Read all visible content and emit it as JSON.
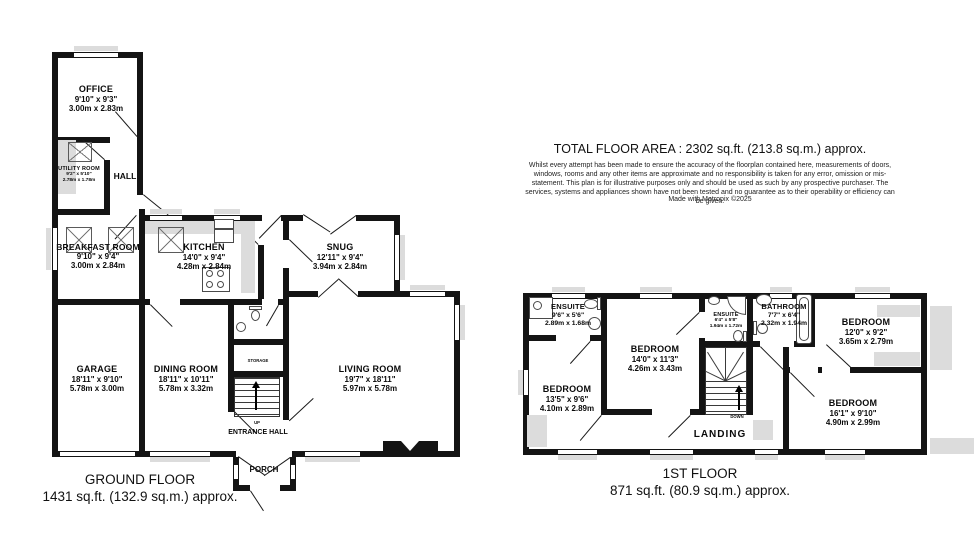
{
  "page": {
    "total_area": "TOTAL FLOOR AREA : 2302 sq.ft. (213.8 sq.m.) approx.",
    "disclaimer": "Whilst every attempt has been made to ensure the accuracy of the floorplan contained here, measurements of doors, windows, rooms and any other items are approximate and no responsibility is taken for any error, omission or mis-statement. This plan is for illustrative purposes only and should be used as such by any prospective purchaser. The services, systems and appliances shown have not been tested and no guarantee as to their operability or efficiency can be given.",
    "credit": "Made with Metropix ©2025"
  },
  "ground_floor": {
    "title": "GROUND FLOOR",
    "area": "1431 sq.ft. (132.9 sq.m.) approx.",
    "stairs_label": "UP",
    "rooms": {
      "office": {
        "name": "OFFICE",
        "imperial": "9'10\" x 9'3\"",
        "metric": "3.00m x 2.83m"
      },
      "utility": {
        "name": "UTILITY ROOM",
        "imperial": "9'2\" x 5'10\"",
        "metric": "2.78m x 1.78m"
      },
      "hall": {
        "name": "HALL"
      },
      "breakfast": {
        "name": "BREAKFAST ROOM",
        "imperial": "9'10\" x 9'4\"",
        "metric": "3.00m x 2.84m"
      },
      "kitchen": {
        "name": "KITCHEN",
        "imperial": "14'0\" x 9'4\"",
        "metric": "4.28m x 2.84m"
      },
      "snug": {
        "name": "SNUG",
        "imperial": "12'11\" x 9'4\"",
        "metric": "3.94m x 2.84m"
      },
      "garage": {
        "name": "GARAGE",
        "imperial": "18'11\" x 9'10\"",
        "metric": "5.78m x 3.00m"
      },
      "dining": {
        "name": "DINING ROOM",
        "imperial": "18'11\" x 10'11\"",
        "metric": "5.78m x 3.32m"
      },
      "living": {
        "name": "LIVING ROOM",
        "imperial": "19'7\" x 18'11\"",
        "metric": "5.97m x 5.78m"
      },
      "storage": {
        "name": "STORAGE"
      },
      "entrance": {
        "name": "ENTRANCE HALL"
      },
      "porch": {
        "name": "PORCH"
      }
    }
  },
  "first_floor": {
    "title": "1ST FLOOR",
    "area": "871 sq.ft. (80.9 sq.m.) approx.",
    "stairs_label": "DOWN",
    "rooms": {
      "ensuite1": {
        "name": "ENSUITE",
        "imperial": "9'6\" x 5'6\"",
        "metric": "2.89m x 1.68m"
      },
      "bedroom1": {
        "name": "BEDROOM",
        "imperial": "14'0\" x 11'3\"",
        "metric": "4.26m x 3.43m"
      },
      "bedroom2": {
        "name": "BEDROOM",
        "imperial": "13'5\" x 9'6\"",
        "metric": "4.10m x 2.89m"
      },
      "ensuite2": {
        "name": "ENSUITE",
        "imperial": "6'4\" x 5'8\"",
        "metric": "1.94m x 1.72m"
      },
      "bathroom": {
        "name": "BATHROOM",
        "imperial": "7'7\" x 6'4\"",
        "metric": "2.32m x 1.94m"
      },
      "bedroom3": {
        "name": "BEDROOM",
        "imperial": "12'0\" x 9'2\"",
        "metric": "3.65m x 2.79m"
      },
      "bedroom4": {
        "name": "BEDROOM",
        "imperial": "16'1\" x 9'10\"",
        "metric": "4.90m x 2.99m"
      },
      "landing": {
        "name": "LANDING"
      }
    }
  }
}
